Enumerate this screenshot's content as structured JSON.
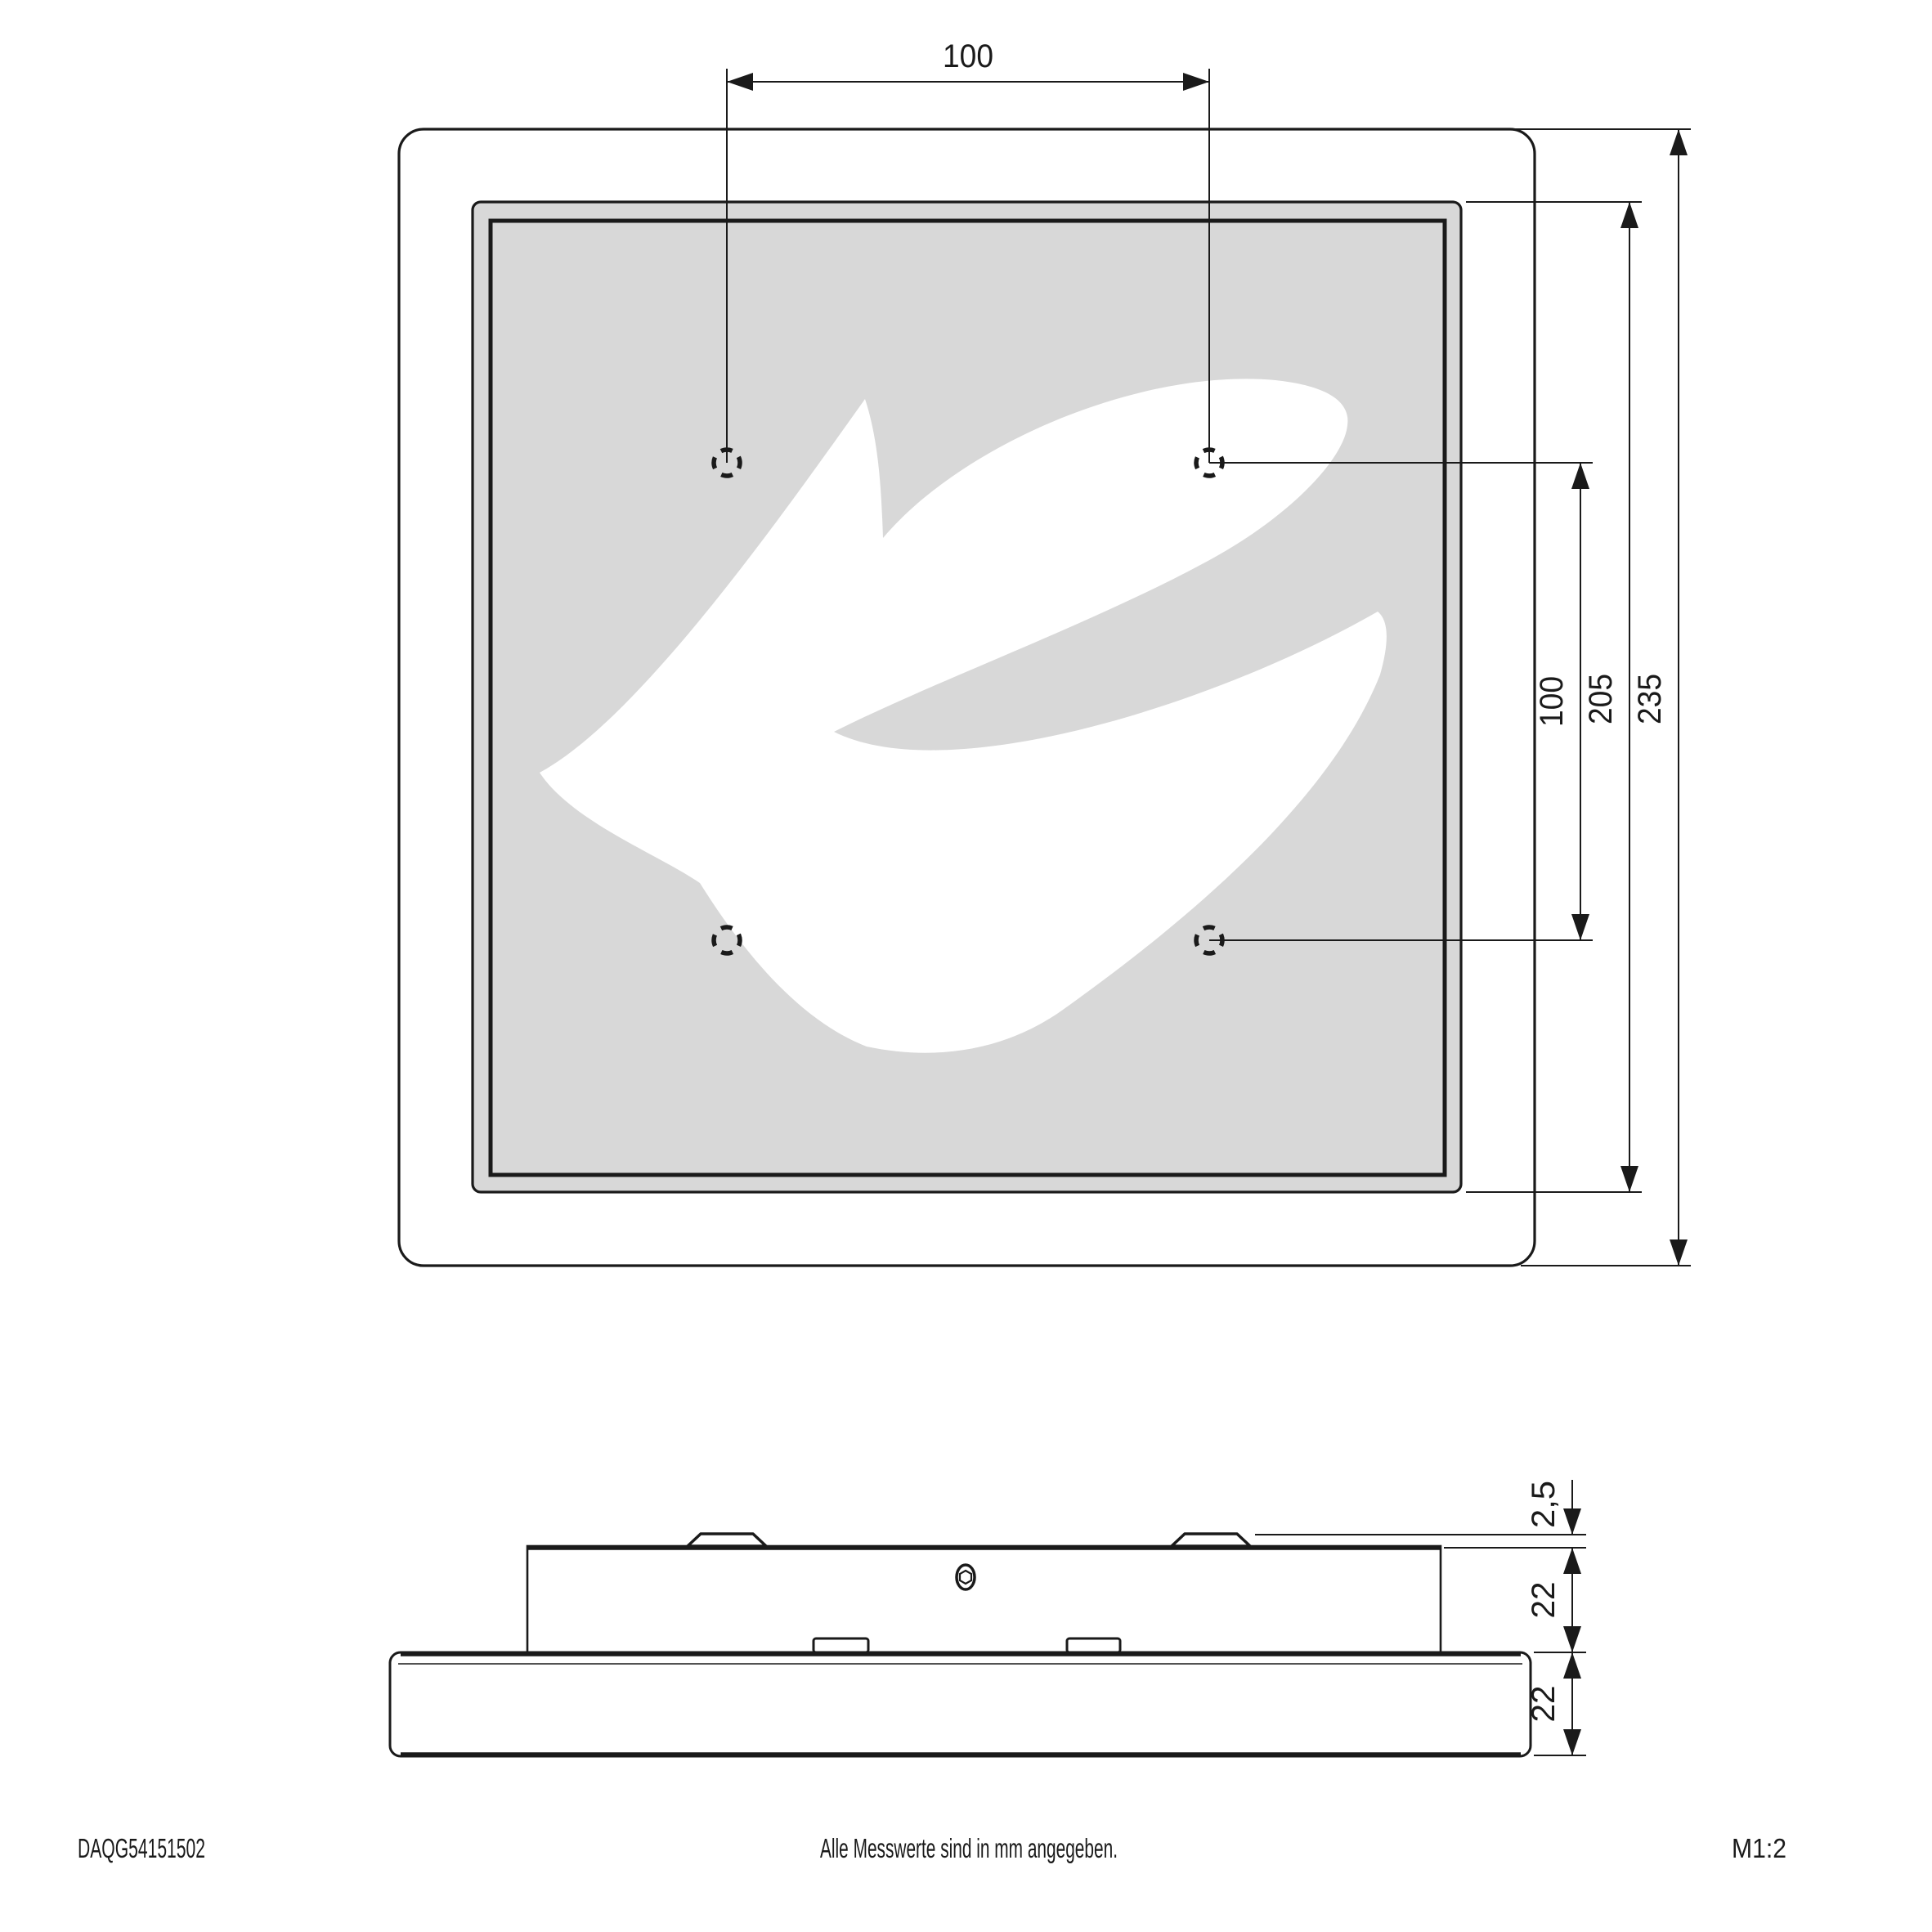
{
  "document": {
    "part_number": "DAQG54151502",
    "note": "Alle Messwerte sind in mm angegeben.",
    "scale": "M1:2"
  },
  "front_view": {
    "dim_hole_spacing_horizontal": "100",
    "dim_hole_spacing_vertical": "100",
    "dim_panel_size": "205",
    "dim_overall_size": "235"
  },
  "side_view": {
    "dim_clip_height": "2,5",
    "dim_housing_height": "22",
    "dim_panel_thickness": "22"
  },
  "colors": {
    "line": "#1a1a1a",
    "panel_gray": "#d8d8d8",
    "logo_white": "#ffffff",
    "background": "#ffffff"
  }
}
